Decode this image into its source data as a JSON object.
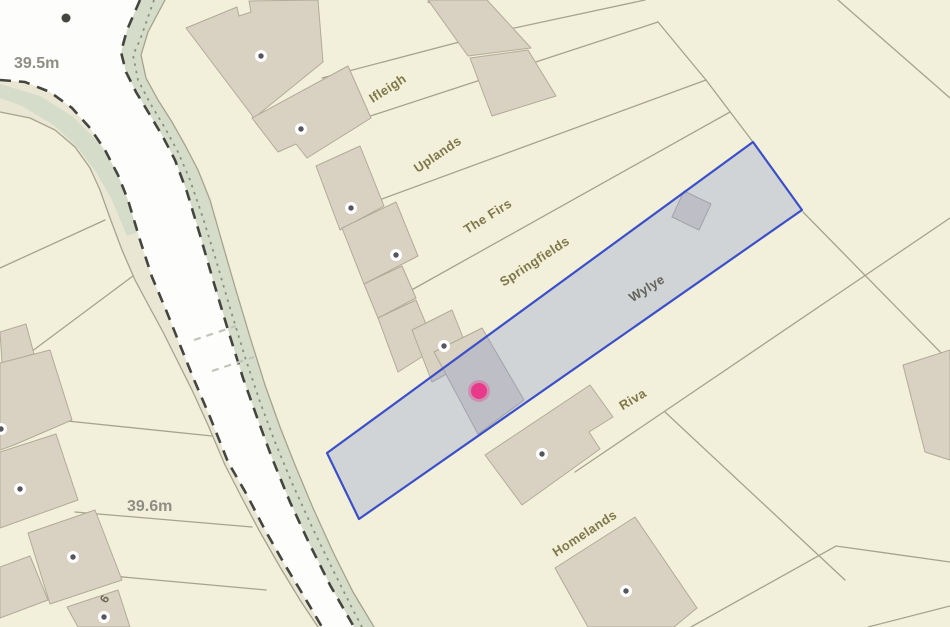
{
  "map": {
    "property_labels": {
      "ifleigh": "Ifleigh",
      "uplands": "Uplands",
      "the_firs": "The Firs",
      "springfields": "Springfields",
      "wylye": "Wylye",
      "riva": "Riva",
      "homelands": "Homelands"
    },
    "spot_heights": {
      "north": "39.5m",
      "south": "39.6m"
    },
    "house_number": "6",
    "selected_plot": {
      "label": "Wylye",
      "outline_color": "#3b4fc9",
      "fill_color": "#8296d2"
    },
    "marker": {
      "type": "selected-property-location",
      "color": "#e8398a"
    },
    "colors": {
      "background": "#f2f0da",
      "road": "#fdfdfb",
      "verge": "#e9e6d4",
      "green_strip": "#d5dcc9",
      "building_fill": "#d9d1c2",
      "building_stroke": "#b2aa99",
      "parcel_line": "#a6a38d",
      "road_dash": "#45453f",
      "label_property": "#80784a",
      "label_height": "#8f8e84"
    }
  }
}
